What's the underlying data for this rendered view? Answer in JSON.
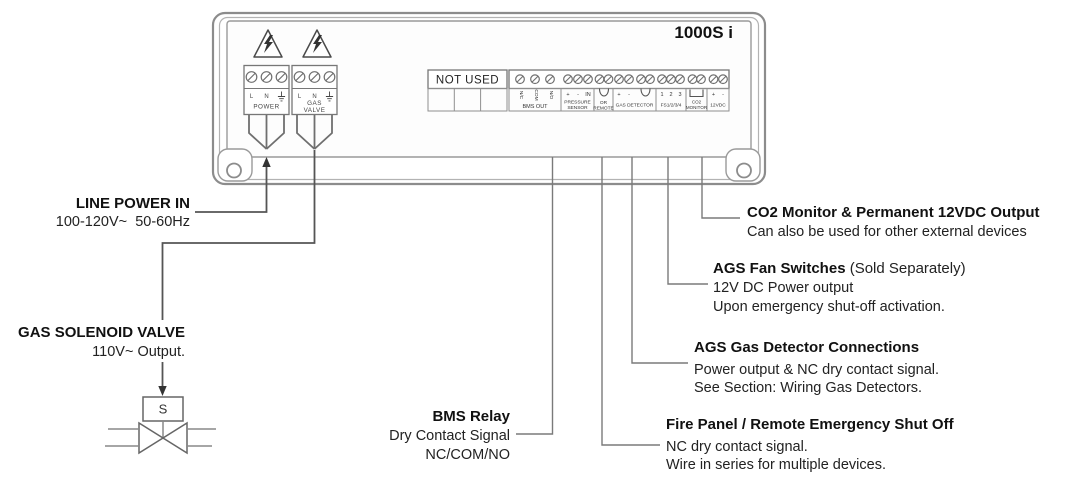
{
  "panel": {
    "model": "1000S i",
    "power_block": {
      "terminal_l": "L",
      "terminal_n": "N",
      "label": "POWER"
    },
    "gas_valve_block": {
      "terminal_l": "L",
      "terminal_n": "N",
      "label_line1": "GAS",
      "label_line2": "VALVE"
    },
    "not_used_label": "NOT USED",
    "strip": {
      "bms_out": {
        "terminals": [
          "N/C",
          "COM",
          "N/O"
        ],
        "label": "BMS OUT"
      },
      "pressure_sensor": {
        "terminals": [
          "+",
          "-",
          "IN"
        ],
        "label_line1": "PRESSURE",
        "label_line2": "SENSOR"
      },
      "remote": {
        "label_line1": "OR",
        "label_line2": "REMOTE"
      },
      "gas_detector": {
        "terminals": [
          "+",
          "-"
        ],
        "label": "GAS DETECTOR"
      },
      "fan_switches": {
        "terminals": [
          "1",
          "2",
          "3"
        ],
        "label": "FS1/2/3/4"
      },
      "co2_monitor": {
        "label_line1": "CO2",
        "label_line2": "MONITOR"
      },
      "dc_12v": {
        "terminals": [
          "+",
          "-"
        ],
        "label": "12VDC"
      }
    }
  },
  "callouts": {
    "line_power": {
      "title": "LINE POWER IN",
      "detail": "100-120V~  50-60Hz"
    },
    "gas_solenoid": {
      "title": "GAS SOLENOID VALVE",
      "detail": "110V~ Output.",
      "valve_letter": "S"
    },
    "bms_relay": {
      "title": "BMS Relay",
      "detail1": "Dry Contact Signal",
      "detail2": "NC/COM/NO"
    },
    "co2_output": {
      "title": "CO2 Monitor & Permanent 12VDC Output",
      "detail1": "Can also be used for other external devices"
    },
    "fan_switches": {
      "title_bold": "AGS Fan Switches",
      "title_normal": " (Sold Separately)",
      "detail1": "12V DC Power output",
      "detail2": "Upon emergency shut-off activation."
    },
    "gas_detector": {
      "title": "AGS Gas Detector Connections",
      "detail1": "Power output & NC dry contact signal.",
      "detail2": "See Section: Wiring Gas Detectors."
    },
    "fire_panel": {
      "title": "Fire Panel / Remote Emergency Shut Off",
      "detail1": "NC dry contact signal.",
      "detail2": "Wire in series for multiple devices."
    }
  },
  "colors": {
    "diagram_line": "#555555",
    "panel_line": "#8c8c8c",
    "text": "#1a1a1a"
  }
}
